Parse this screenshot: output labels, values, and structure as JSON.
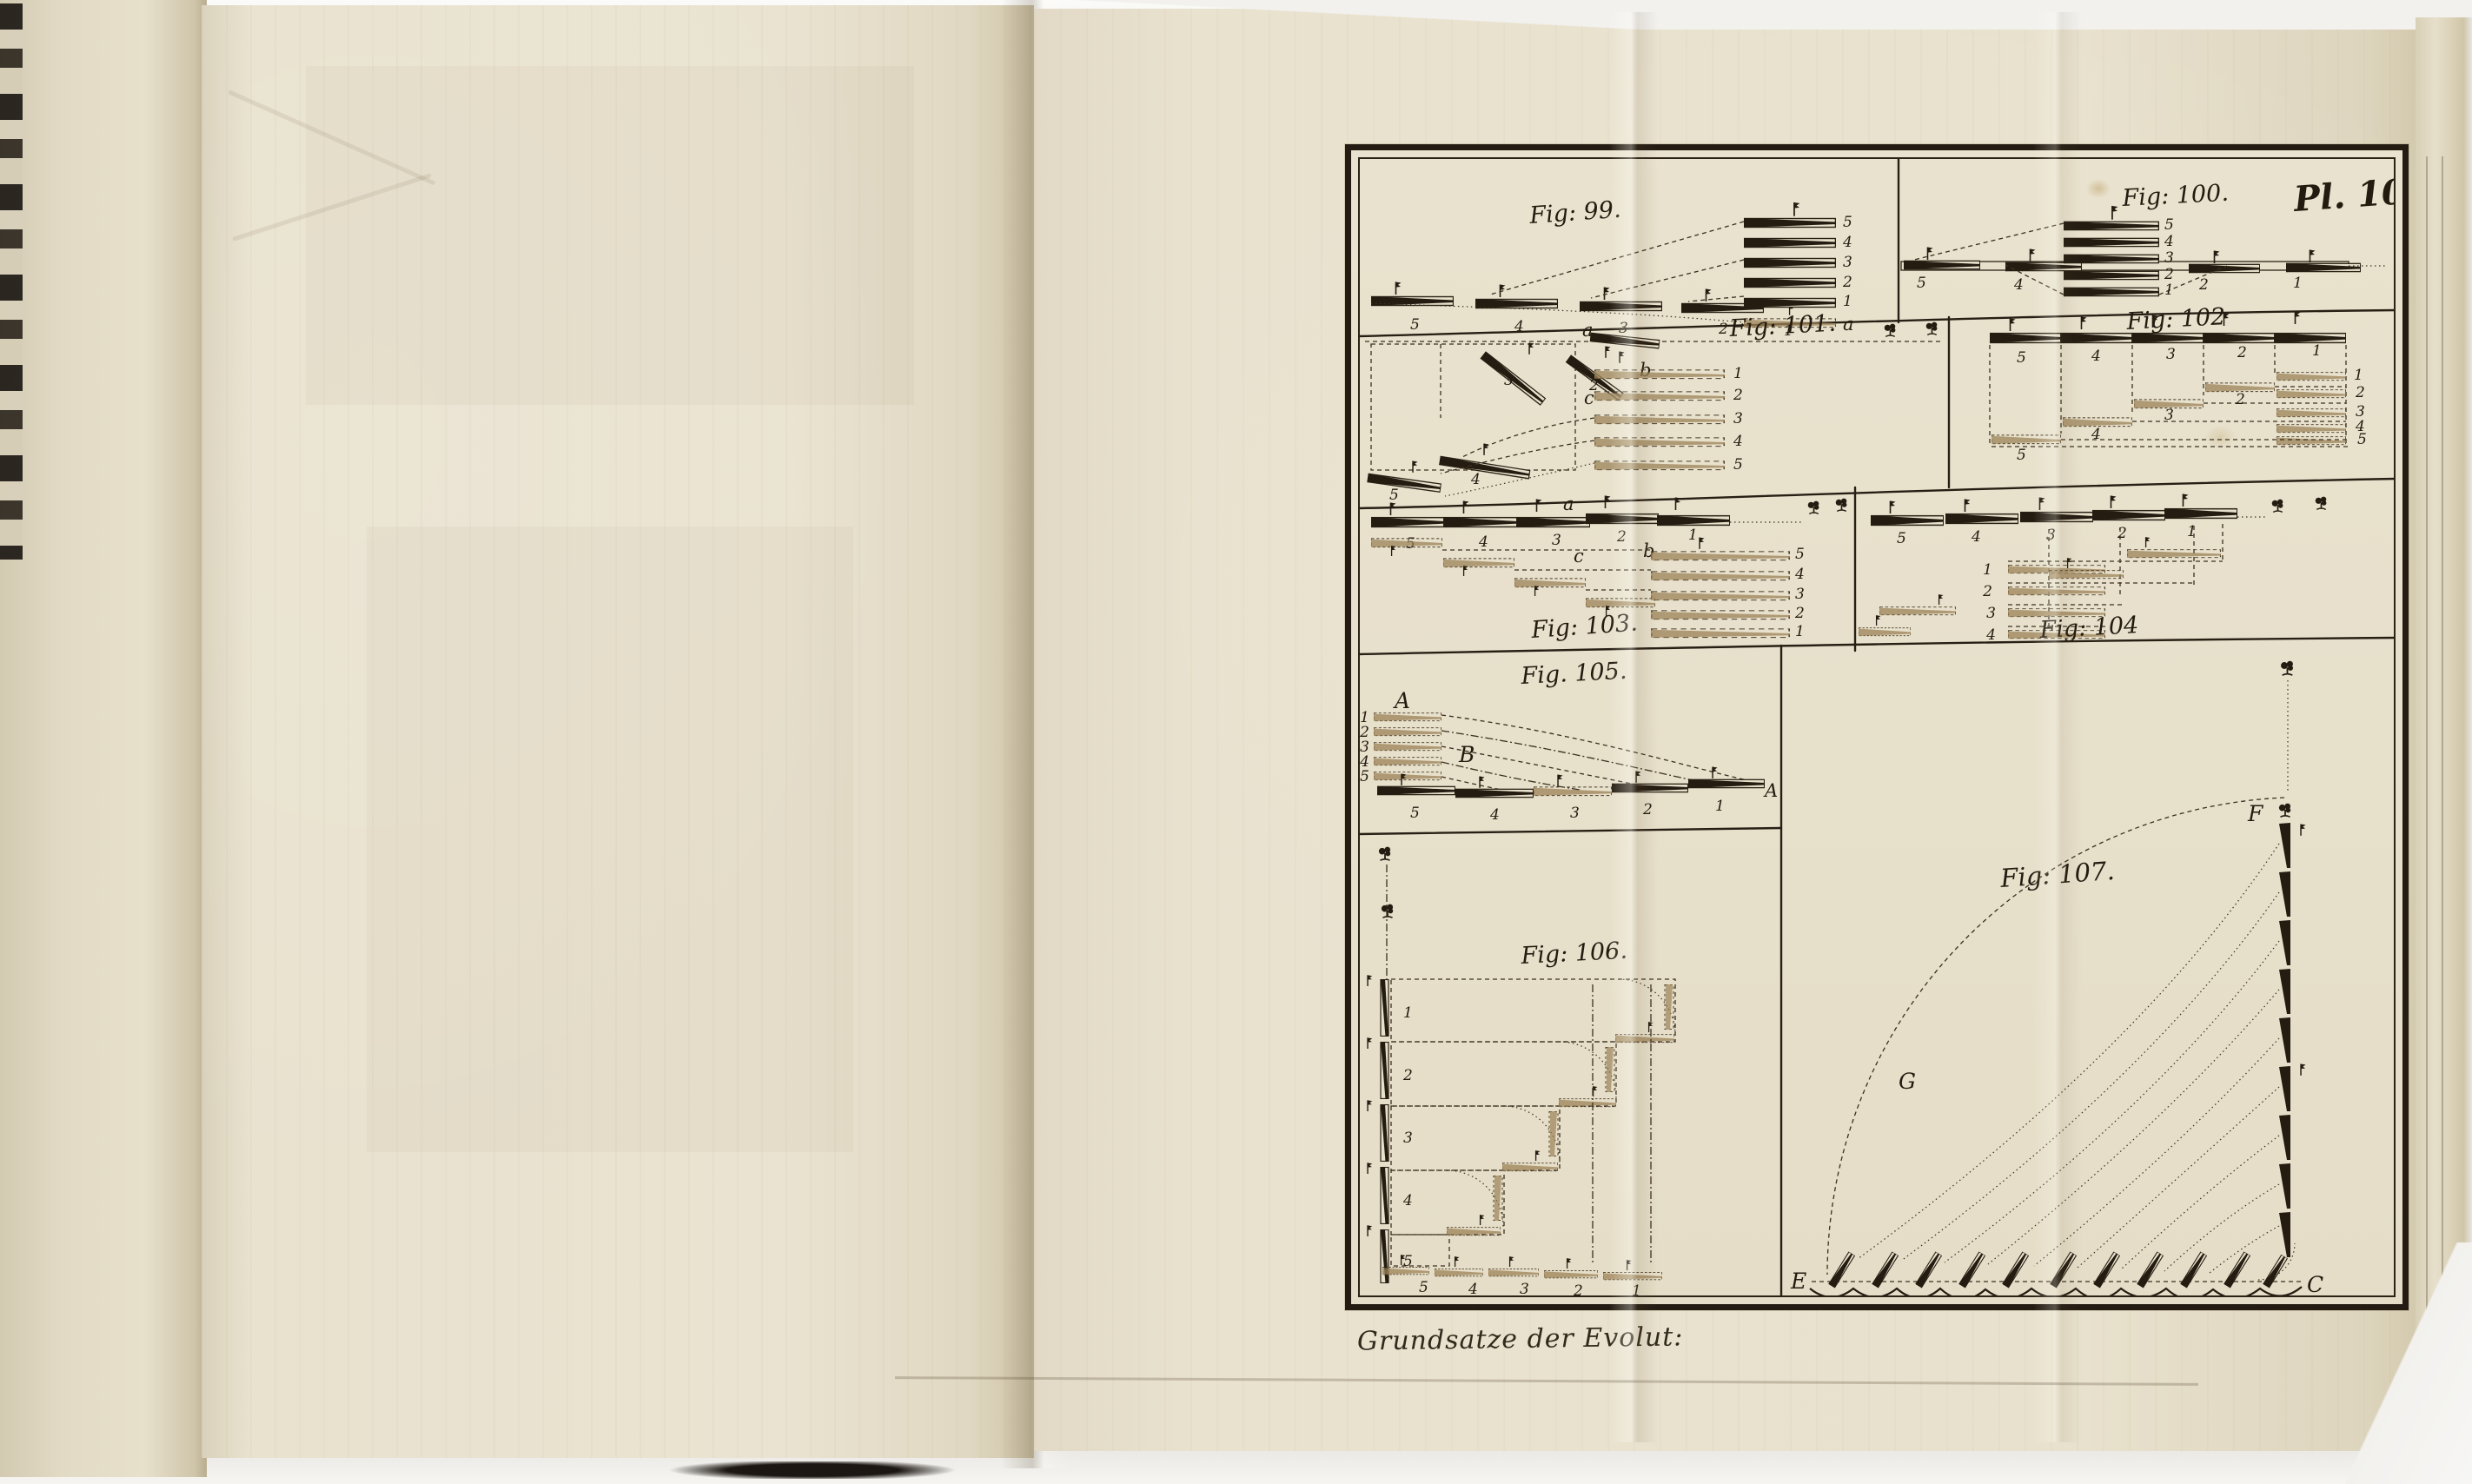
{
  "plate": {
    "number": "Pl. 10.",
    "caption": "Grundsatze der Evolut:"
  },
  "colors": {
    "ink": "#241b10",
    "paper": "#e7e0cc",
    "ghost_tan": "#9b8257"
  },
  "icons": {
    "tree-icon": "small engraved tree marker",
    "flag-icon": "battalion flag pennant"
  },
  "figures": {
    "f99": {
      "label": "Fig: 99.",
      "bottom": [
        "5",
        "4",
        "3",
        "2",
        "1"
      ],
      "stack": [
        "5",
        "4",
        "3",
        "2",
        "1",
        "a"
      ]
    },
    "f100": {
      "label": "Fig: 100.",
      "line": [
        "5",
        "4",
        "2",
        "1"
      ],
      "stack": [
        "5",
        "4",
        "3",
        "2",
        "1"
      ]
    },
    "f101": {
      "label": "Fig: 101.",
      "a": "a",
      "b": "b",
      "c": "c",
      "tilted": [
        "3",
        "2",
        "4",
        "5"
      ],
      "stack": [
        "1",
        "2",
        "3",
        "4",
        "5"
      ]
    },
    "f102": {
      "label": "Fig: 102",
      "top": [
        "5",
        "4",
        "3",
        "2",
        "1"
      ],
      "ghost": [
        "5",
        "4",
        "3",
        "2"
      ],
      "stack": [
        "1",
        "2",
        "3",
        "4",
        "5"
      ]
    },
    "f103": {
      "label": "Fig: 103.",
      "a": "a",
      "b": "b",
      "c": "c",
      "top": [
        "5",
        "4",
        "3",
        "2",
        "1"
      ],
      "stack": [
        "5",
        "4",
        "3",
        "2",
        "1"
      ]
    },
    "f104": {
      "label": "Fig: 104",
      "top": [
        "5",
        "4",
        "3",
        "2",
        "1"
      ],
      "stack": [
        "1",
        "2",
        "3",
        "4"
      ]
    },
    "f105": {
      "label": "Fig. 105.",
      "A": "A",
      "B": "B",
      "A2": "A",
      "stack": [
        "1",
        "2",
        "3",
        "4",
        "5"
      ],
      "bottom": [
        "5",
        "4",
        "3",
        "2",
        "1"
      ]
    },
    "f106": {
      "label": "Fig: 106.",
      "column": [
        "1",
        "2",
        "3",
        "4",
        "5"
      ],
      "bottom": [
        "5",
        "4",
        "3",
        "2",
        "1"
      ]
    },
    "f107": {
      "label": "Fig: 107.",
      "F": "F",
      "G": "G",
      "E": "E",
      "C": "C"
    }
  }
}
